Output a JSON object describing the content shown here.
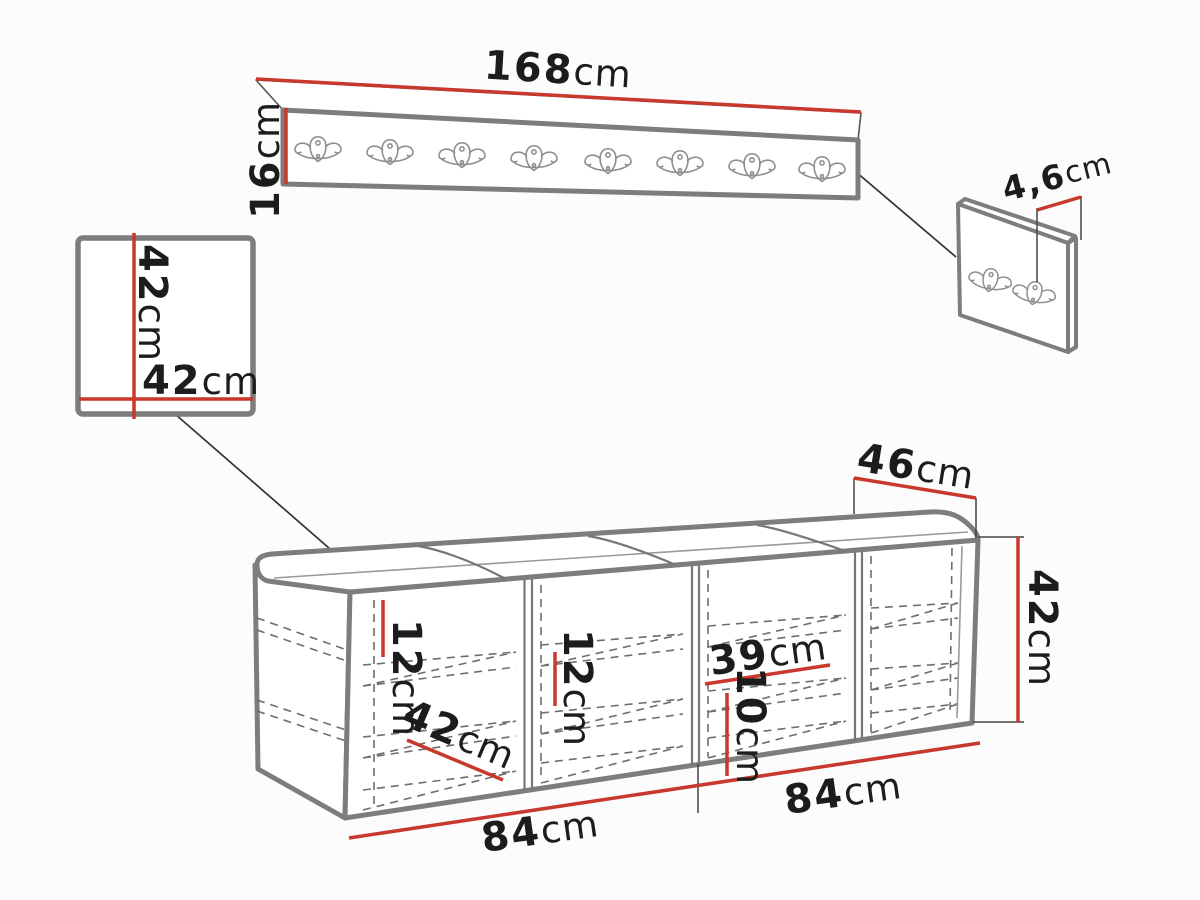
{
  "colors": {
    "dimension": "#c8382c",
    "outline": "#7d7d7d",
    "text": "#1c1c1c",
    "background": "#fcfcfc"
  },
  "components": {
    "coat_rack": {
      "hook_count": 8,
      "width": {
        "value": "168",
        "unit": "cm"
      },
      "height": {
        "value": "16",
        "unit": "cm"
      }
    },
    "hook_panel": {
      "hook_count": 2,
      "depth": {
        "value": "4,6",
        "unit": "cm"
      }
    },
    "square_panel": {
      "height": {
        "value": "42",
        "unit": "cm"
      },
      "width": {
        "value": "42",
        "unit": "cm"
      }
    },
    "bench": {
      "compartment_count": 4,
      "depth": {
        "value": "46",
        "unit": "cm"
      },
      "height": {
        "value": "42",
        "unit": "cm"
      },
      "shelf_gap_left": {
        "value": "12",
        "unit": "cm"
      },
      "shelf_gap_middle": {
        "value": "12",
        "unit": "cm"
      },
      "niche_width": {
        "value": "39",
        "unit": "cm"
      },
      "niche_height": {
        "value": "10",
        "unit": "cm"
      },
      "niche_depth": {
        "value": "42",
        "unit": "cm"
      },
      "half_width_left": {
        "value": "84",
        "unit": "cm"
      },
      "half_width_right": {
        "value": "84",
        "unit": "cm"
      }
    }
  }
}
